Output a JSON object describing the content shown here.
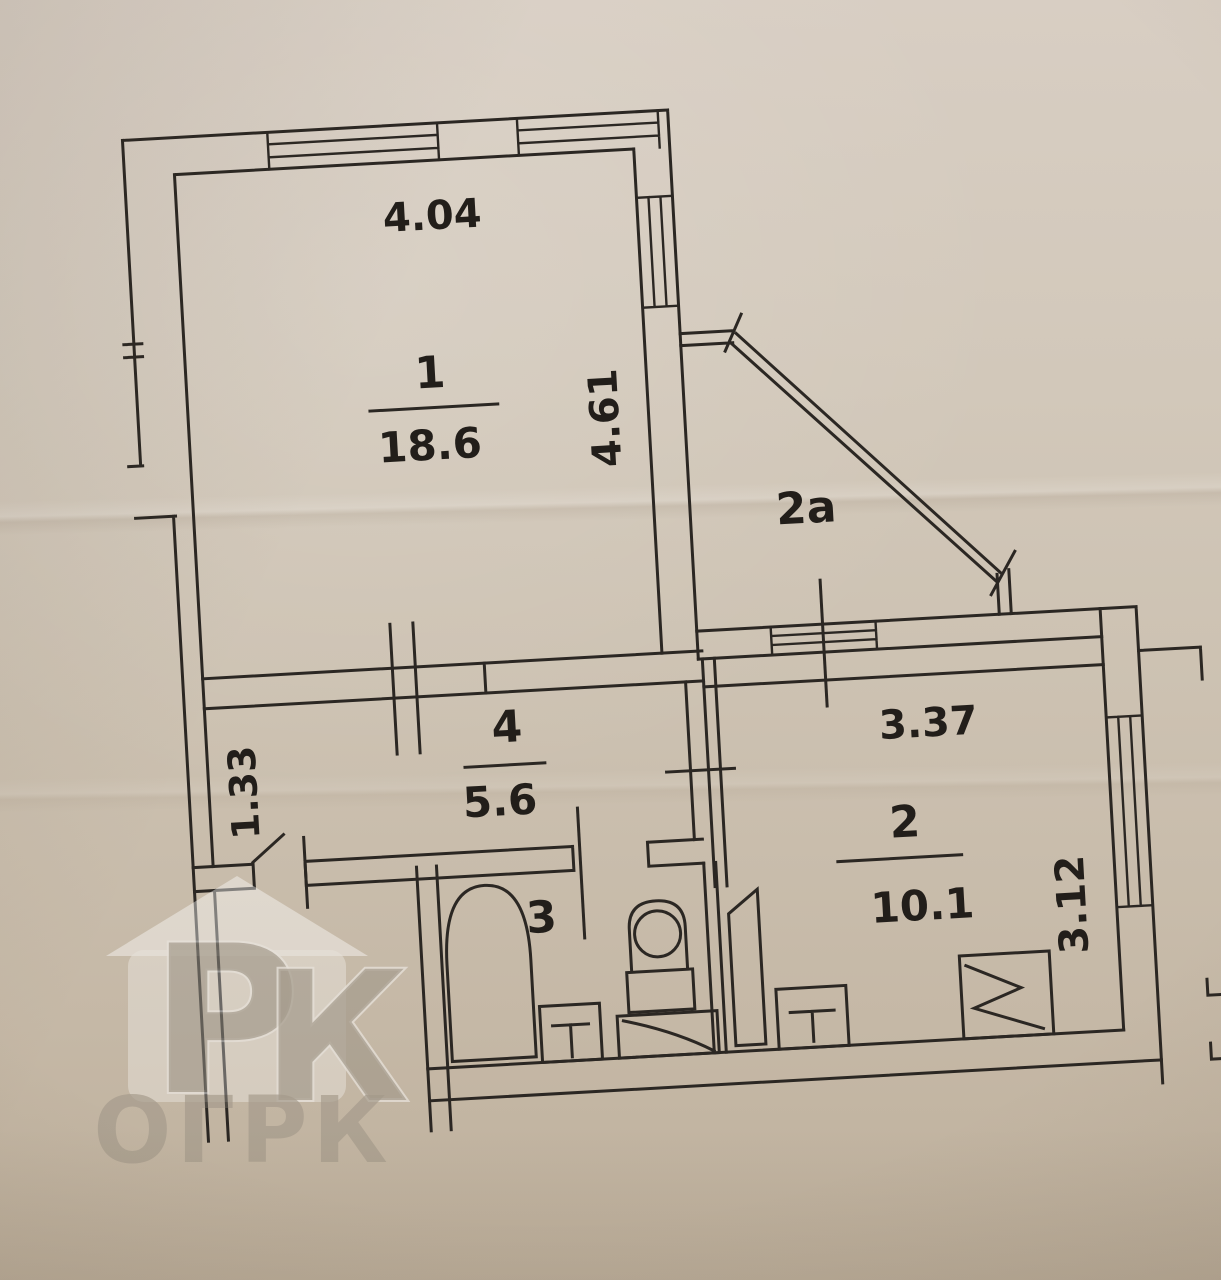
{
  "plan": {
    "room1": {
      "number": "1",
      "area": "18.6",
      "width_m": "4.04",
      "depth_m": "4.61"
    },
    "loggia": {
      "label": "2а"
    },
    "room2": {
      "number": "2",
      "area": "10.1",
      "width_m": "3.37",
      "depth_m": "3.12"
    },
    "room3": {
      "number": "3"
    },
    "room4": {
      "number": "4",
      "area": "5.6",
      "width_m": "1.33"
    }
  },
  "watermark": {
    "letter_p": "Р",
    "letter_k": "К",
    "caption": "ОГРК"
  },
  "colors": {
    "paper": "#cfc5b6",
    "ink": "#2b2723",
    "watermark_gray": "#8a8377"
  }
}
